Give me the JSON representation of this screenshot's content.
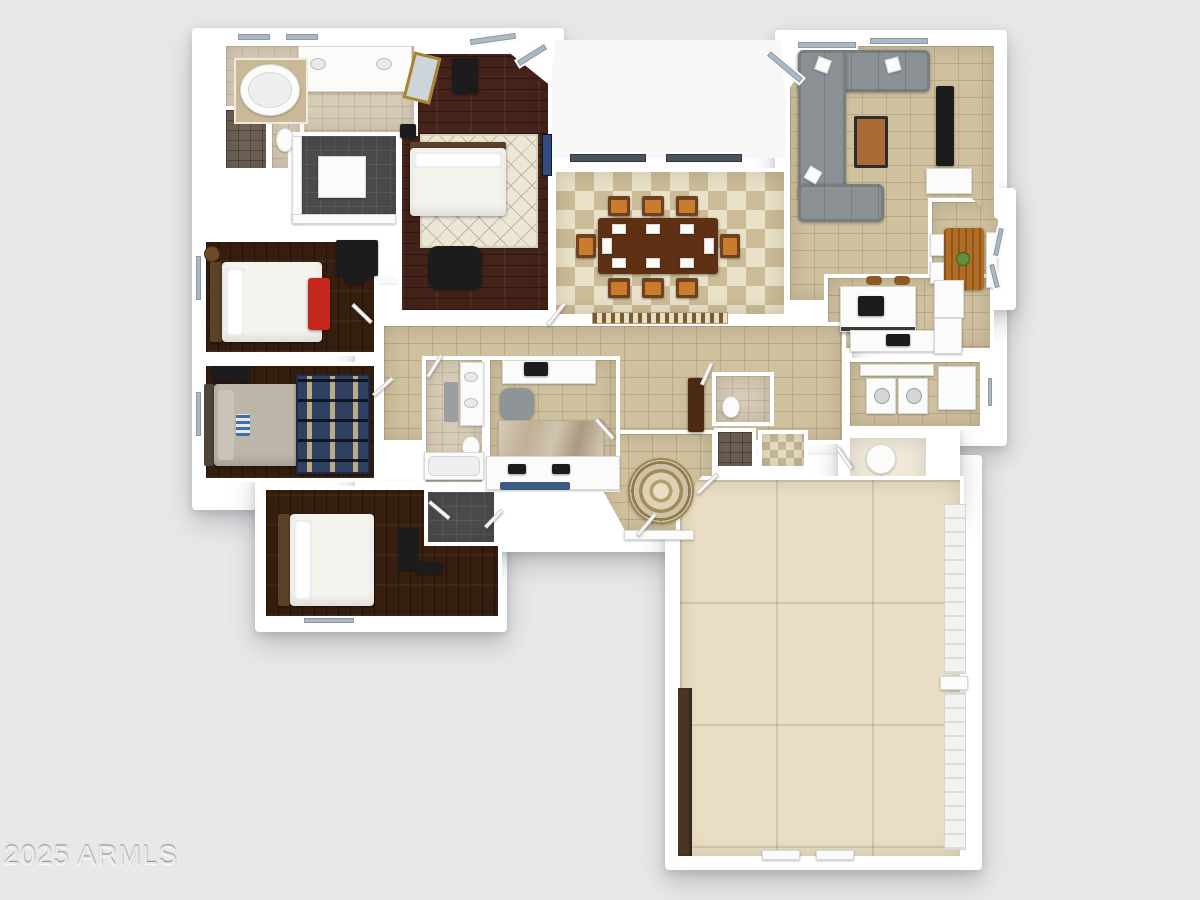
{
  "watermark": {
    "text": "2025 ARMLS"
  },
  "palette": {
    "background": "#e7e8e9",
    "wall": "#ffffff",
    "tile_tan": "#cfc19e",
    "tile_cream": "#e9e1c8",
    "tile_diamond": "#cbbc97",
    "bath_tile": "#d7cbb6",
    "wood_master": "#45231a",
    "wood_bedroom": "#371f10",
    "closet_dark": "#4b4b4d",
    "garage_floor": "#e9dec3",
    "passage_cream": "#f0e9d8",
    "counter_white": "#fbfbfa",
    "sofa_gray": "#8a9094",
    "bed_white": "#f4f3ee",
    "headboard_brown": "#5a4128",
    "bench_red": "#c5271d",
    "table_wood": "#5e3014",
    "chair_wood": "#6f4120",
    "chair_orange": "#c97b2e",
    "nook_wood": "#b26d24",
    "rug_cream": "#ece6d4",
    "rug_navy": "#2f4060",
    "window_glass": "#aab9c3",
    "tv_navy": "#2f4d80",
    "shower_dark": "#6e6156",
    "appliance_black": "#1c1c1c",
    "watermark_color": "#e9e9e9"
  }
}
